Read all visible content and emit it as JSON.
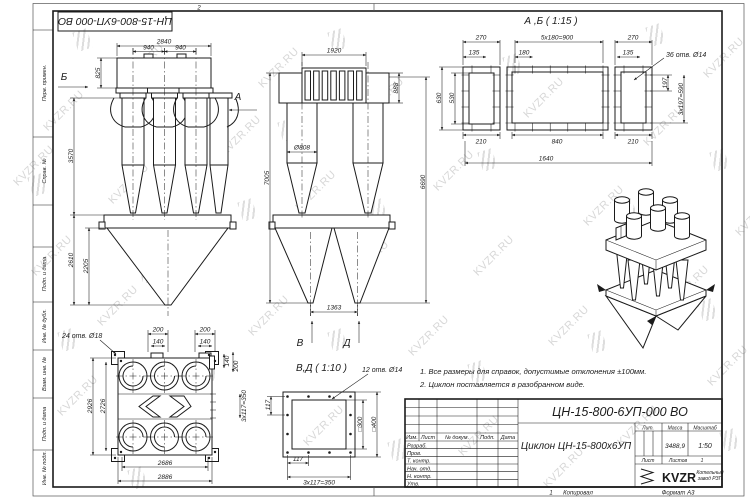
{
  "watermark": {
    "text": "KVZR.RU"
  },
  "frame": {
    "doc_number_top": "ЦН-15-800-6УП-000 ВО",
    "zone_top": "2",
    "zone_bottom": "1",
    "side_labels": [
      "Перв. примен.",
      "Справ. №",
      "Подп. и дата",
      "Инв. № дубл.",
      "Взам. инв. №",
      "Подп. и дата",
      "Инв. № подл."
    ]
  },
  "notes": {
    "line1": "1. Все размеры для справок, допустимые отклонения ±100мм.",
    "line2": "2. Циклон поставляется в разобранном виде."
  },
  "views": {
    "front": {
      "label_b": "Б",
      "label_a": "А",
      "dim_width": "2840",
      "dim_pitch_1": "940",
      "dim_pitch_2": "940",
      "dim_inlet": "825",
      "dim_body": "3570",
      "dim_hopper": "2610",
      "dim_cone": "2205"
    },
    "side": {
      "dim_width": "1920",
      "dim_flange": "888",
      "dim_total": "7005",
      "dim_right": "6690",
      "dim_pipe": "Ø808",
      "dim_outlets": "1363",
      "label_v": "В",
      "label_d": "Д"
    },
    "ab": {
      "title": "А ,Б ( 1:15 )",
      "dim_270_l": "270",
      "dim_900": "5x180=900",
      "dim_270_r": "270",
      "dim_135_l": "135",
      "dim_180": "180",
      "dim_135_r": "135",
      "holes": "36 отв. Ø14",
      "dim_197": "197",
      "dim_590": "3x197=590",
      "dim_530": "530",
      "dim_630": "630",
      "dim_210_l": "210",
      "dim_840": "840",
      "dim_210_r": "210",
      "dim_1640": "1640"
    },
    "plan": {
      "holes": "24 отв. Ø18",
      "dim_200_1": "200",
      "dim_140_1": "140",
      "dim_200_2": "200",
      "dim_140_2": "140",
      "dim_140_r": "140",
      "dim_200_r": "200",
      "dim_2926": "2926",
      "dim_2726": "2726",
      "dim_350": "3x117=350",
      "dim_2686": "2686",
      "dim_2886": "2886"
    },
    "vd": {
      "title": "В,Д ( 1:10 )",
      "holes": "12 отв. Ø14",
      "dim_117_l": "117",
      "dim_300": "□300",
      "dim_400": "□400",
      "dim_117_b": "117",
      "dim_350": "3x117=350"
    }
  },
  "title_block": {
    "doc_number": "ЦН-15-800-6УП-000 ВО",
    "name": "Циклон ЦН-15-800х6УП",
    "lit_label": "Лит.",
    "mass_label": "Масса",
    "scale_label": "Масштаб",
    "mass": "3488,9",
    "scale": "1:50",
    "sheet_label": "Лист",
    "sheets_label": "Листов",
    "sheets": "1",
    "header_cols": [
      "Изм.",
      "Лист",
      "№ докум.",
      "Подп.",
      "Дата"
    ],
    "rows": [
      "Разраб.",
      "Пров.",
      "Т. контр.",
      "Нач. отд.",
      "Н. контр.",
      "Утв."
    ],
    "copied": "Копировал",
    "format": "Формат А3",
    "logo": "KVZR",
    "logo_caption_1": "Котельный",
    "logo_caption_2": "завод РЗП"
  }
}
